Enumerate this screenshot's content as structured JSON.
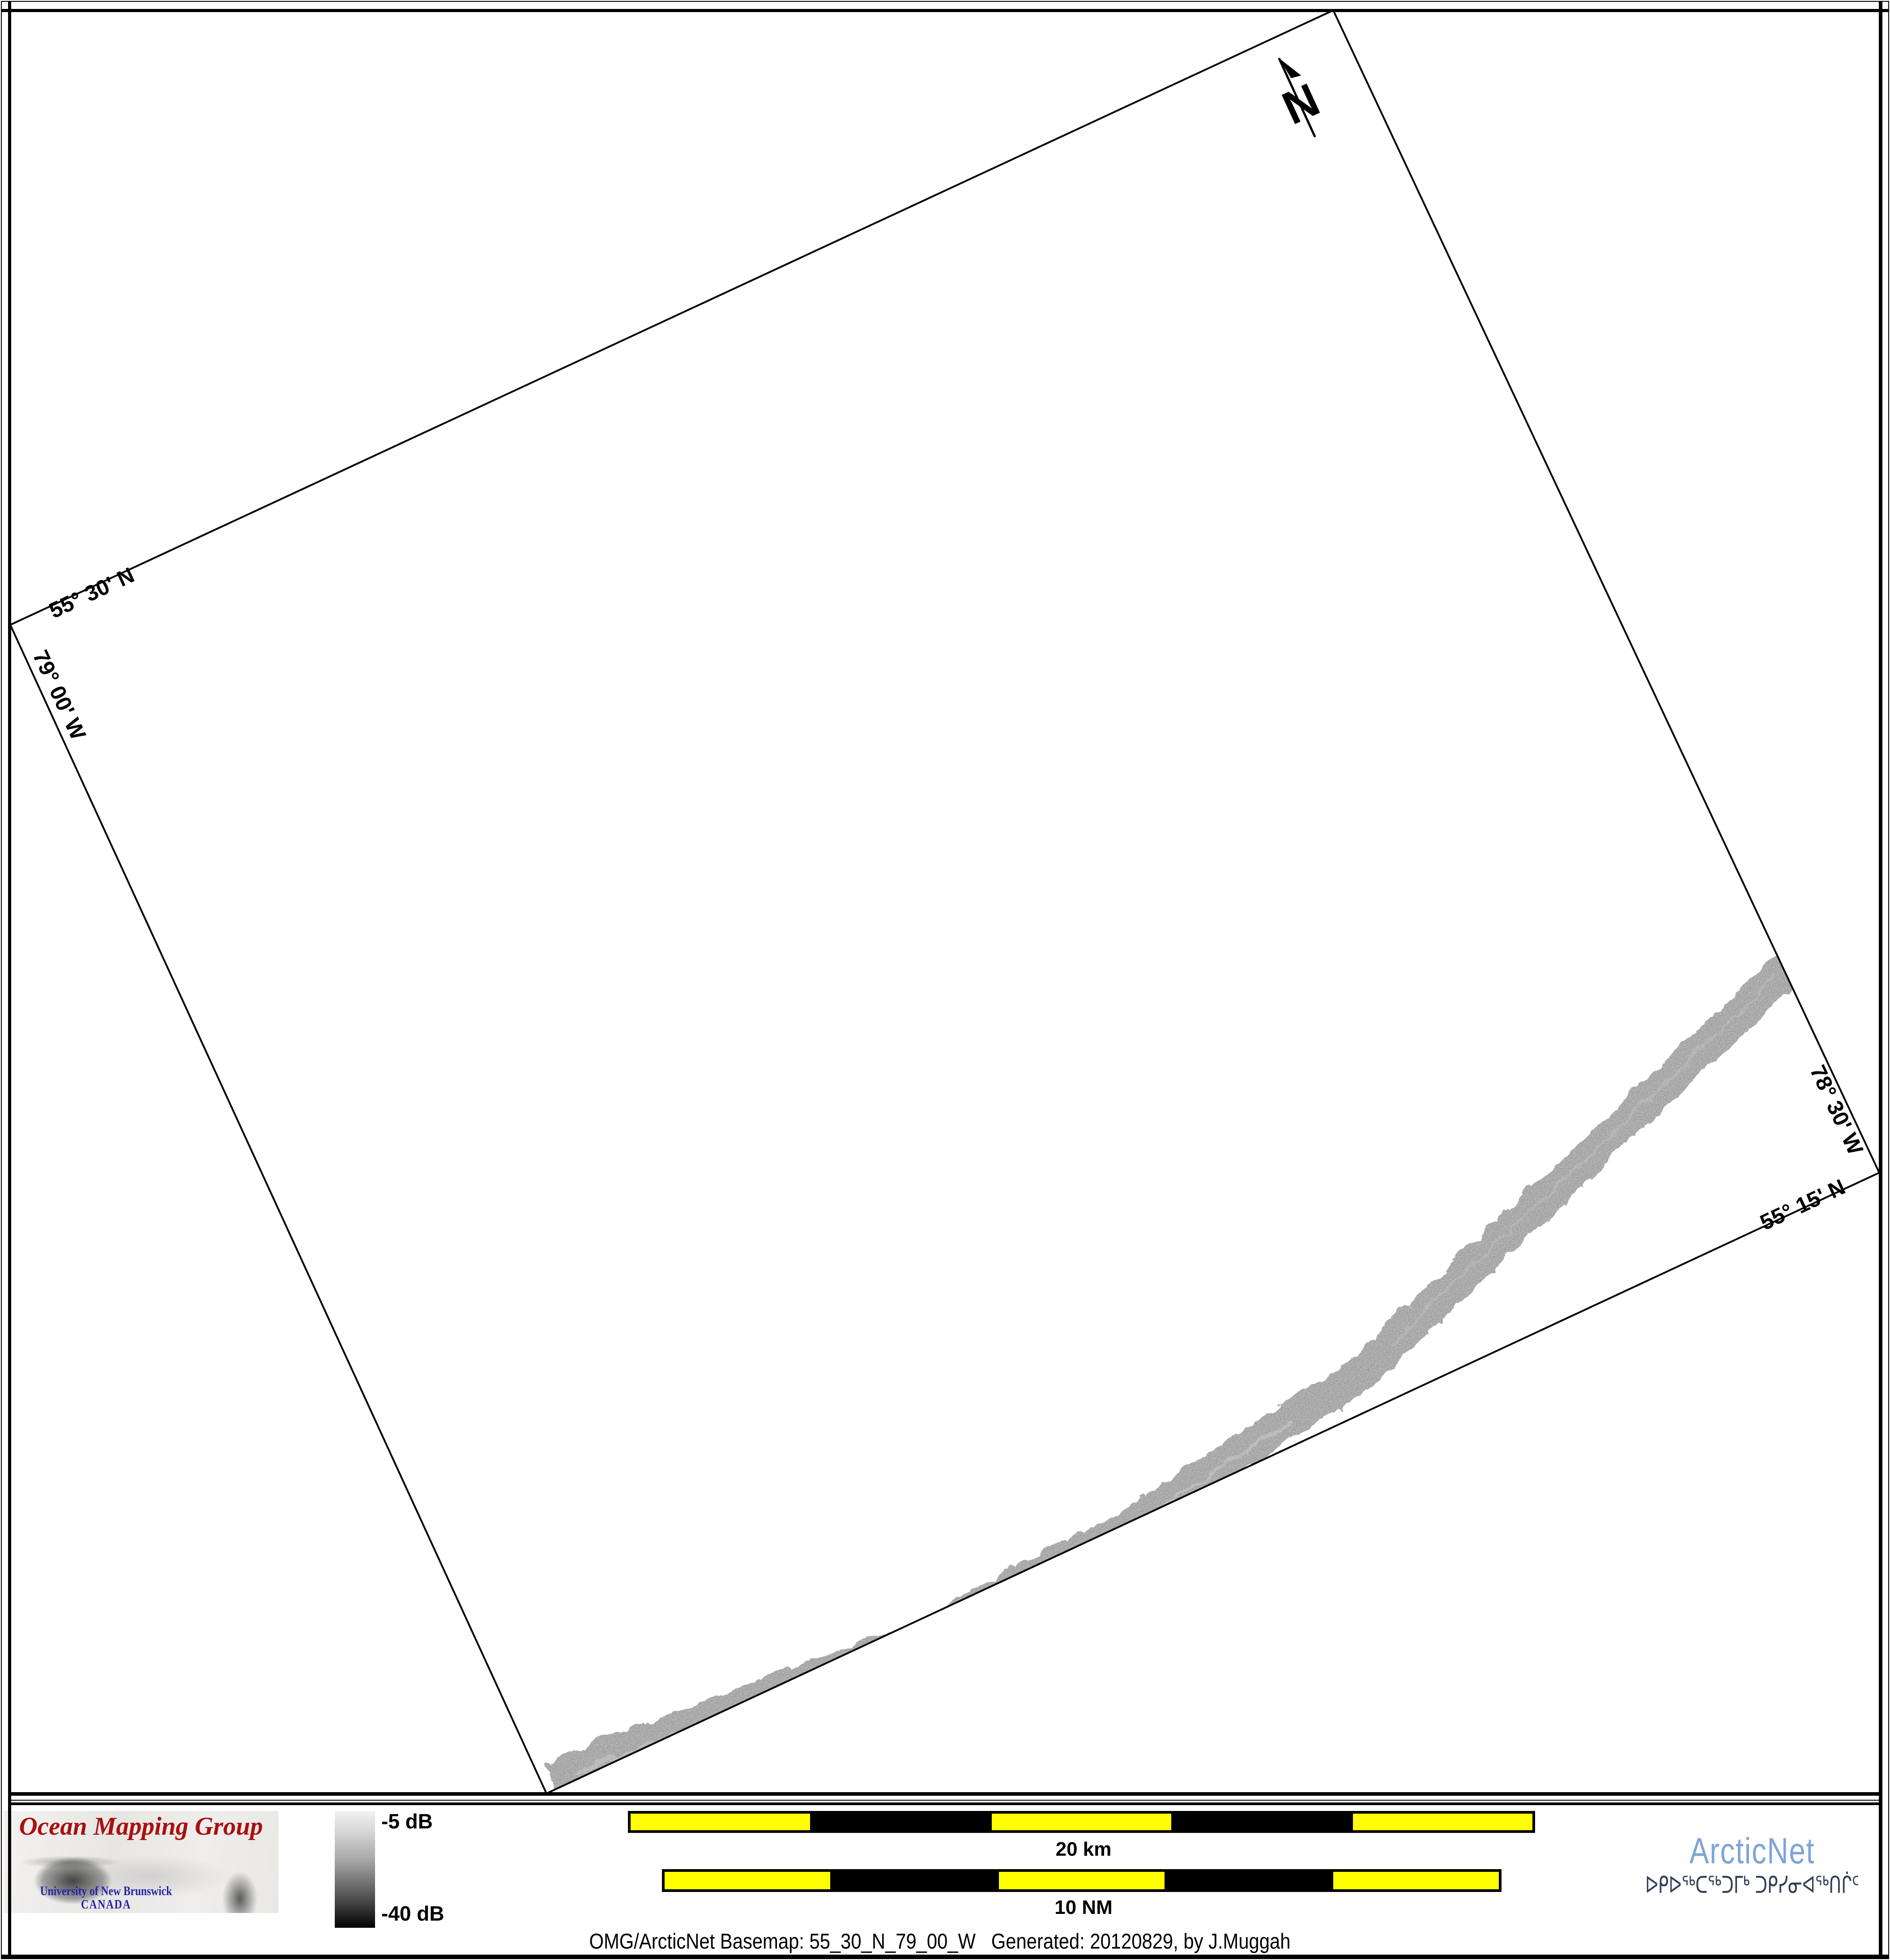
{
  "page": {
    "background": "#ffffff",
    "frame_color": "#000000"
  },
  "map": {
    "graticule": {
      "lat_top": "55° 30' N",
      "lon_left": "79° 00' W",
      "lon_right": "78° 30' W",
      "lat_bottom": "55° 15' N"
    },
    "north_label": "N",
    "track": {
      "name": "multibeam-backscatter-swath",
      "base_color": "#8d8d8d"
    }
  },
  "footer": {
    "omg_logo": {
      "title": "Ocean Mapping Group",
      "title_color": "#a8100f",
      "subtitle1": "University of New Brunswick",
      "subtitle2": "CANADA",
      "subtitle_color": "#2424aa"
    },
    "colorbar": {
      "top_label": "-5 dB",
      "bottom_label": "-40 dB",
      "top_color": "#f2f2f2",
      "bottom_color": "#000000"
    },
    "scalebar_km": {
      "label": "20 km",
      "segment_colors": [
        "#ffff00",
        "#000000",
        "#ffff00",
        "#000000",
        "#ffff00"
      ]
    },
    "scalebar_nm": {
      "label": "10 NM",
      "segment_colors": [
        "#ffff00",
        "#000000",
        "#ffff00",
        "#000000",
        "#ffff00"
      ]
    },
    "arcticnet_logo": {
      "name": "ArcticNet",
      "name_color": "#7da5d7",
      "inuktitut": "ᐅᑭᐅᖅᑕᖅᑐᒥᒃ ᑐᑭᓯᓂᐊᖅᑎᒌᑦ",
      "inuktitut_color": "#2f3e54"
    },
    "caption": "OMG/ArcticNet Basemap: 55_30_N_79_00_W   Generated: 20120829, by J.Muggah"
  }
}
